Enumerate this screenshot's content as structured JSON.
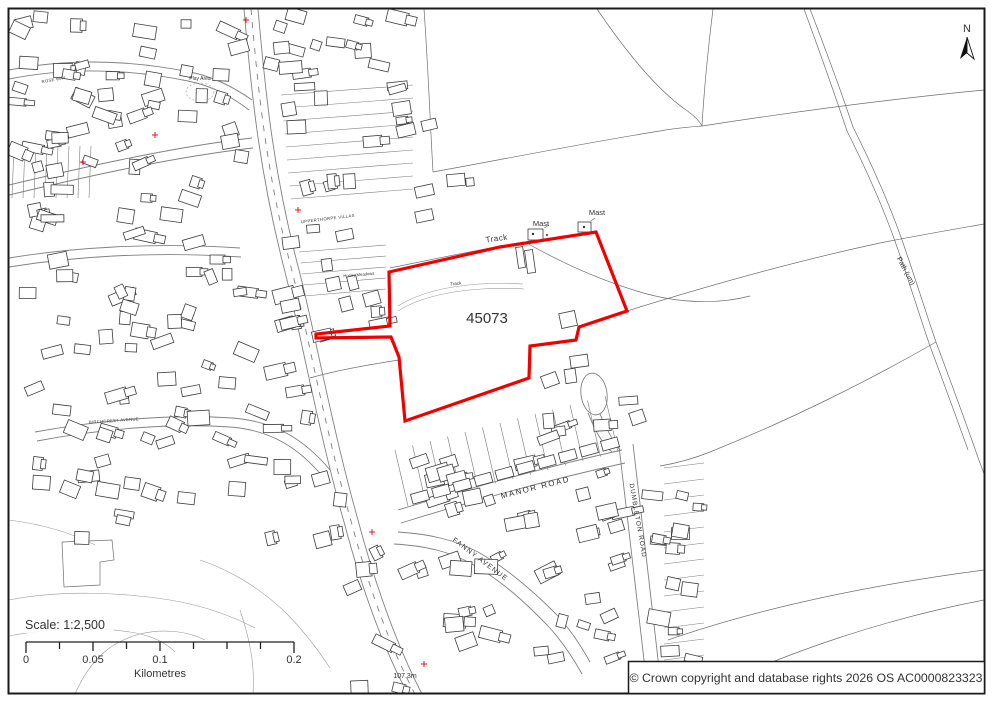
{
  "page": {
    "background": "#ffffff",
    "border_color": "#1a1a1a"
  },
  "map": {
    "site_ref": "45073",
    "boundary_color": "#f10000",
    "north_label": "N",
    "labels": [
      {
        "text": "Track",
        "x": 497,
        "y": 241,
        "rot": -8,
        "size": 8,
        "spacing": 0.5
      },
      {
        "text": "Track",
        "x": 456,
        "y": 285,
        "rot": -6,
        "size": 4.5,
        "spacing": 0
      },
      {
        "text": "Mast",
        "x": 541,
        "y": 226,
        "rot": 0,
        "size": 7.5,
        "spacing": 0
      },
      {
        "text": "Mast",
        "x": 597,
        "y": 215,
        "rot": 0,
        "size": 7.5,
        "spacing": 0
      },
      {
        "text": "MANOR ROAD",
        "x": 536,
        "y": 490,
        "rot": -14,
        "size": 8,
        "spacing": 1.6
      },
      {
        "text": "FANNY AVENUE",
        "x": 479,
        "y": 561,
        "rot": 37,
        "size": 7,
        "spacing": 1.2
      },
      {
        "text": "DUMBLETON ROAD",
        "x": 636,
        "y": 521,
        "rot": 80,
        "size": 6.5,
        "spacing": 1
      },
      {
        "text": "Path (um)",
        "x": 904,
        "y": 272,
        "rot": 62,
        "size": 7,
        "spacing": 0
      },
      {
        "text": "UPPERTHORPE VILLAS",
        "x": 328,
        "y": 220,
        "rot": -7,
        "size": 4.2,
        "spacing": 0.4
      },
      {
        "text": "Honey Meadows",
        "x": 359,
        "y": 276,
        "rot": -5,
        "size": 4.2,
        "spacing": 0
      },
      {
        "text": "BIRCHCREST AVENUE",
        "x": 114,
        "y": 422,
        "rot": -4,
        "size": 4.2,
        "spacing": 0.3
      },
      {
        "text": "ROSE WAY",
        "x": 54,
        "y": 81,
        "rot": -10,
        "size": 4.2,
        "spacing": 0.3
      },
      {
        "text": "Play Area",
        "x": 200,
        "y": 80,
        "rot": 0,
        "size": 5,
        "spacing": 0
      },
      {
        "text": "107.3m",
        "x": 405,
        "y": 678,
        "rot": 0,
        "size": 7,
        "spacing": 0
      }
    ],
    "spot_markers": [
      {
        "x": 424,
        "y": 664
      },
      {
        "x": 246,
        "y": 20
      },
      {
        "x": 155,
        "y": 135
      },
      {
        "x": 83,
        "y": 162
      },
      {
        "x": 298,
        "y": 210
      },
      {
        "x": 372,
        "y": 532
      }
    ]
  },
  "scalebar": {
    "scale_text": "Scale: 1:2,500",
    "unit_label": "Kilometres",
    "tick_labels": [
      "0",
      "0.05",
      "0.1",
      "0.2"
    ]
  },
  "attribution": {
    "text": "© Crown copyright and database rights 2026 OS AC0000823323"
  }
}
